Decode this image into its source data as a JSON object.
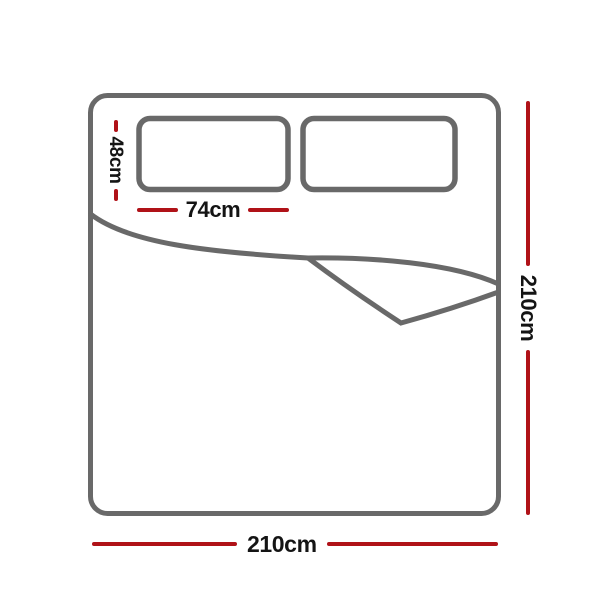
{
  "diagram": {
    "subject": "quilt-cover-bed-dimension-diagram",
    "colors": {
      "outline": "#696969",
      "dimension": "#b01218",
      "label": "#141414",
      "background": "#ffffff"
    },
    "labels": {
      "pillow_height": "48cm",
      "pillow_width": "74cm",
      "length_right": "210cm",
      "width_bottom": "210cm"
    },
    "measurements": [
      {
        "name": "pillowcase height",
        "value": 48,
        "unit": "cm"
      },
      {
        "name": "pillowcase width",
        "value": 74,
        "unit": "cm"
      },
      {
        "name": "quilt cover length",
        "value": 210,
        "unit": "cm"
      },
      {
        "name": "quilt cover width",
        "value": 210,
        "unit": "cm"
      }
    ]
  }
}
